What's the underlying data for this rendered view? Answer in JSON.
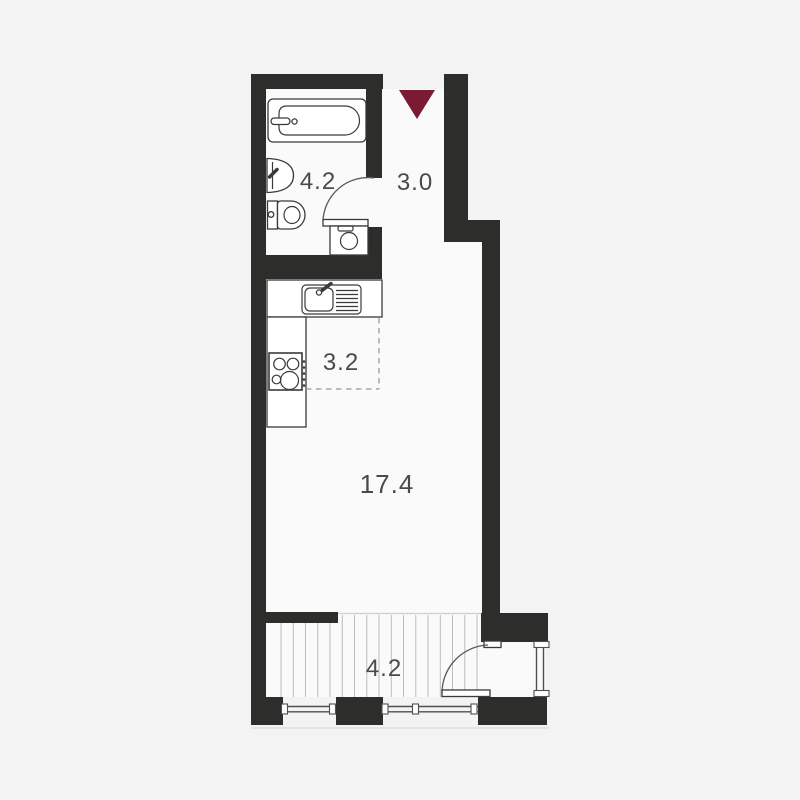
{
  "plan": {
    "title": "studio-apartment-floor-plan",
    "rooms": [
      {
        "id": "bathroom",
        "area": "4.2"
      },
      {
        "id": "hallway",
        "area": "3.0"
      },
      {
        "id": "kitchen",
        "area": "3.2"
      },
      {
        "id": "living-room",
        "area": "17.4"
      },
      {
        "id": "balcony",
        "area": "4.2"
      }
    ],
    "entrance_marker": "down-triangle"
  },
  "colors": {
    "background": "#f3f3f4",
    "floor": "#fafafa",
    "wall": "#2d2d2c",
    "accent": "#7a1b33",
    "line": "#3a3a3a",
    "label": "#4a4a4a",
    "hatch": "#bcbcbc",
    "glaze": "#4f4f4f"
  }
}
